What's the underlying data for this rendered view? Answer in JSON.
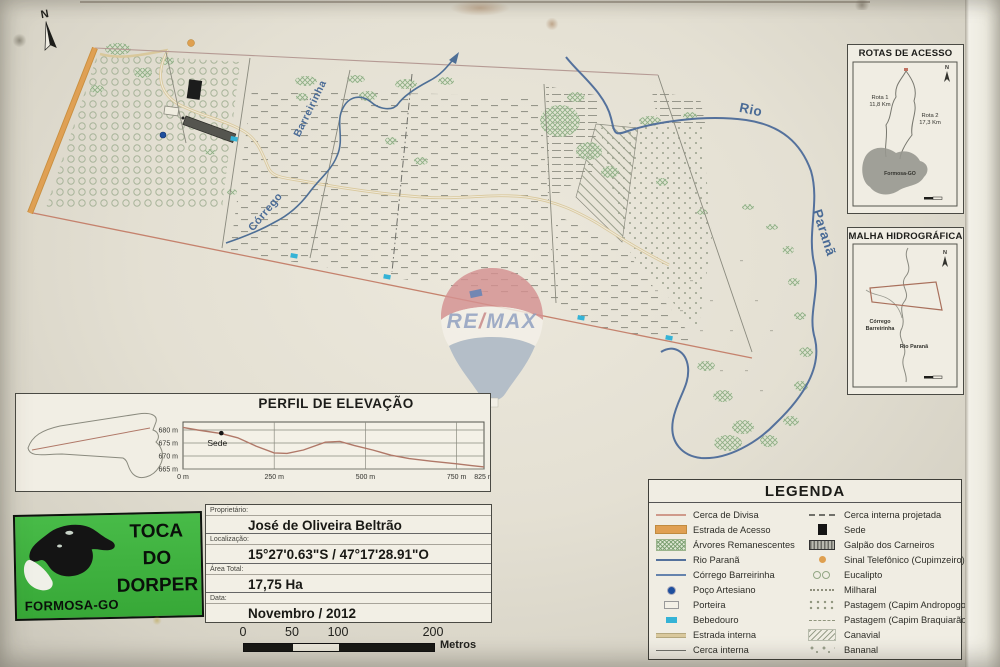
{
  "page": {
    "north_label": "N",
    "watermark_parts": [
      "RE",
      "/",
      "MAX"
    ]
  },
  "map_labels": {
    "corrego": "Córrego",
    "barreirinha": "Barreirinha",
    "rio": "Rio",
    "parana": "Paranã"
  },
  "insets": {
    "rotas": {
      "title": "ROTAS DE ACESSO",
      "rota1_name": "Rota 1",
      "rota1_dist": "11,8 Km",
      "rota2_name": "Rota 2",
      "rota2_dist": "17,3 Km",
      "city": "Formosa-GO"
    },
    "malha": {
      "title": "MALHA HIDROGRÁFICA",
      "corrego_line1": "Córrego",
      "corrego_line2": "Barreirinha",
      "rio": "Rio Paranã"
    }
  },
  "elevation": {
    "title": "PERFIL DE ELEVAÇÃO"
  },
  "chart_data": {
    "type": "line",
    "title": "PERFIL DE ELEVAÇÃO",
    "xlabel": "distância (m)",
    "ylabel": "elevação (m)",
    "x_ticks": [
      0,
      250,
      500,
      750,
      825
    ],
    "y_ticks": [
      680,
      675,
      670,
      665
    ],
    "ylim": [
      665,
      681.5
    ],
    "xlim": [
      0,
      825
    ],
    "x_m": [
      0,
      40,
      105,
      150,
      200,
      250,
      285,
      330,
      390,
      430,
      470,
      520,
      570,
      620,
      680,
      750,
      790,
      825
    ],
    "elev_m": [
      681,
      680,
      678.6,
      677,
      673.8,
      671.2,
      671,
      672.3,
      675.3,
      675.6,
      674,
      672.3,
      670.3,
      669,
      668,
      667,
      666.3,
      665.8
    ],
    "annotations": [
      {
        "label": "Sede",
        "x_m": 105,
        "elev_m": 678.8
      }
    ]
  },
  "info": {
    "rows": [
      {
        "label": "Proprietário:",
        "value": "José de Oliveira Beltrão"
      },
      {
        "label": "Localização:",
        "value": "15°27'0.63\"S / 47°17'28.91\"O"
      },
      {
        "label": "Área Total:",
        "value": "17,75 Ha"
      },
      {
        "label": "Data:",
        "value": "Novembro / 2012"
      }
    ]
  },
  "logo": {
    "title_lines": [
      "TOCA",
      "DO",
      "DORPER"
    ],
    "city": "FORMOSA-GO"
  },
  "scale_bar": {
    "ticks": [
      "0",
      "50",
      "100",
      "200"
    ],
    "unit": "Metros"
  },
  "legend": {
    "title": "LEGENDA",
    "left": [
      {
        "symbol": "cerca-divisa",
        "label": "Cerca de Divisa"
      },
      {
        "symbol": "estrada-acesso",
        "label": "Estrada de Acesso"
      },
      {
        "symbol": "arvores",
        "label": "Árvores Remanescentes"
      },
      {
        "symbol": "rio",
        "label": "Rio Paranã"
      },
      {
        "symbol": "corrego",
        "label": "Córrego Barreirinha"
      },
      {
        "symbol": "poco",
        "label": "Poço Artesiano"
      },
      {
        "symbol": "porteira",
        "label": "Porteira"
      },
      {
        "symbol": "bebedouro",
        "label": "Bebedouro"
      },
      {
        "symbol": "estrada-interna",
        "label": "Estrada interna"
      },
      {
        "symbol": "cerca-interna",
        "label": "Cerca interna"
      }
    ],
    "right": [
      {
        "symbol": "cerca-projetada",
        "label": "Cerca interna projetada"
      },
      {
        "symbol": "sede",
        "label": "Sede"
      },
      {
        "symbol": "galpao",
        "label": "Galpão dos Carneiros"
      },
      {
        "symbol": "sinal",
        "label": "Sinal Telefônico (Cupimzeiro)"
      },
      {
        "symbol": "eucalipto",
        "label": "Eucalipto"
      },
      {
        "symbol": "milharal",
        "label": "Milharal"
      },
      {
        "symbol": "andropogon",
        "label": "Pastagem (Capim Andropogon)"
      },
      {
        "symbol": "braquiarao",
        "label": "Pastagem (Capim Braquiarão)"
      },
      {
        "symbol": "canavial",
        "label": "Canavial"
      },
      {
        "symbol": "bananal",
        "label": "Bananal"
      }
    ]
  },
  "colors": {
    "access_road": "#dfa054",
    "divisa_fence": "#c5826d",
    "river_blue": "#54719c",
    "bebedouro_cyan": "#35b3d6",
    "logo_green": "#3cb23c",
    "balloon_red": "#d59191",
    "balloon_blue": "#a9b6c5"
  }
}
